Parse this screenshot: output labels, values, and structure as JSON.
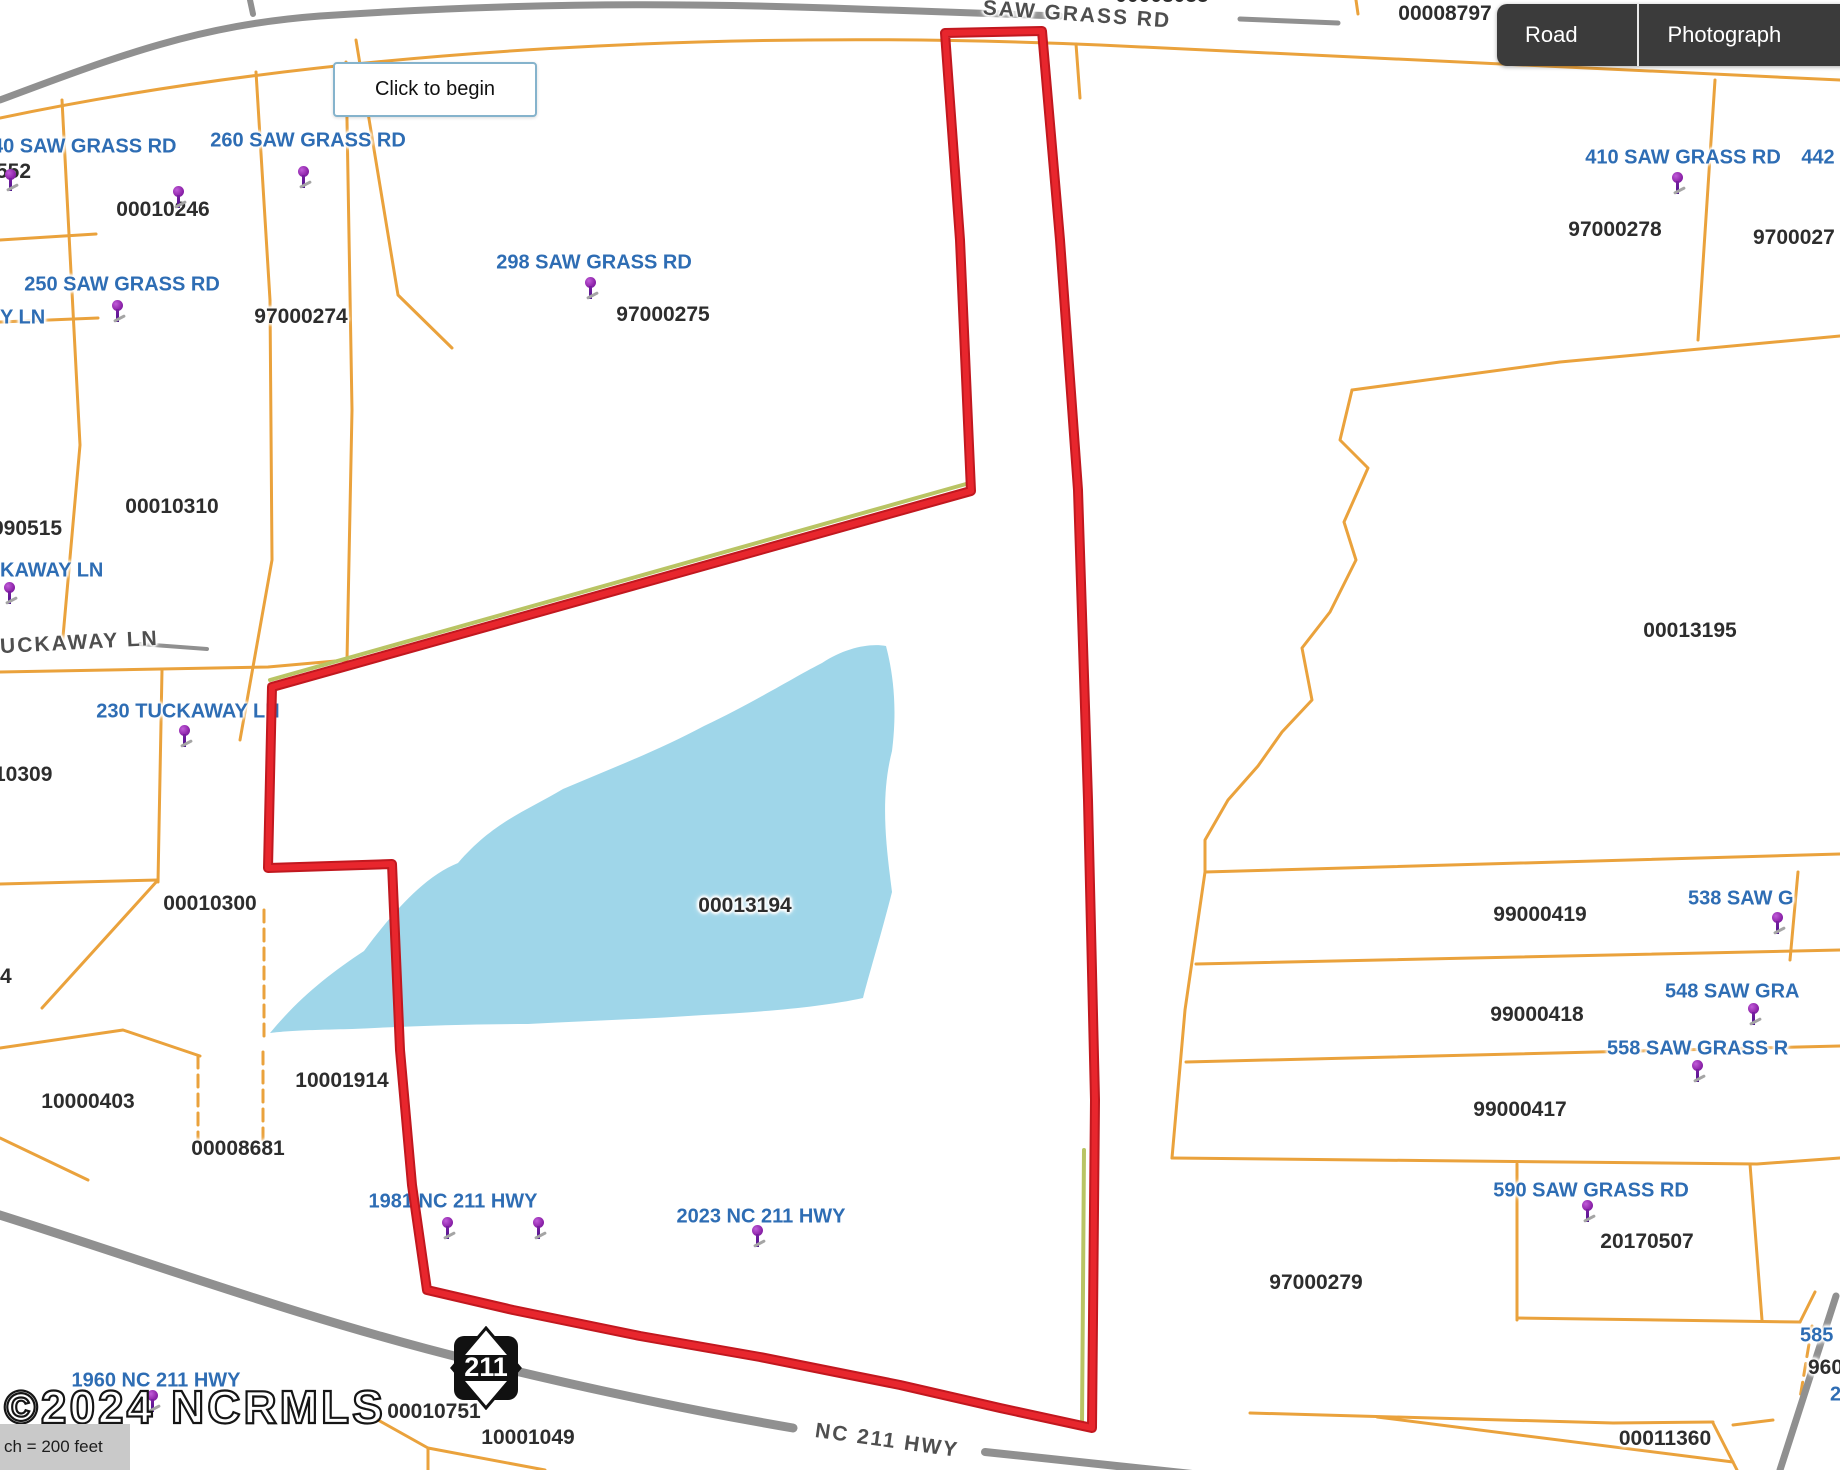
{
  "view_controls": {
    "buttons": [
      {
        "label": "Road Map"
      },
      {
        "label": "Photograph"
      }
    ]
  },
  "tooltip": {
    "text": "Click to begin"
  },
  "watermark": {
    "text": "©2024 NCRMLS"
  },
  "scale_bar": {
    "text": "ch = 200 feet"
  },
  "highway_shield": {
    "route": "211"
  },
  "colors": {
    "parcel_line": "#eaa23c",
    "road": "#909090",
    "water": "#9fd6e9",
    "subject_outline": "#dd2127",
    "address_text": "#2e6db4",
    "parcel_text": "#2d2d2d",
    "pin": "#8e24aa"
  },
  "map": {
    "road_labels": [
      {
        "text": "SAW GRASS RD",
        "x": 1077,
        "y": 15,
        "rot": 4
      },
      {
        "text": "UCKAWAY LN",
        "x": 0,
        "y": 643,
        "rot": -3,
        "anchor": "left"
      },
      {
        "text": "NC 211 HWY",
        "x": 887,
        "y": 1441,
        "rot": 8
      }
    ],
    "parcel_numbers": [
      {
        "text": "00008797",
        "x": 1445,
        "y": 14
      },
      {
        "text": "00008055",
        "x": 1162,
        "y": -4
      },
      {
        "text": "00010246",
        "x": 163,
        "y": 210
      },
      {
        "text": "552",
        "x": -4,
        "y": 172,
        "anchor": "left"
      },
      {
        "text": "97000274",
        "x": 301,
        "y": 317
      },
      {
        "text": "97000275",
        "x": 663,
        "y": 315
      },
      {
        "text": "97000278",
        "x": 1615,
        "y": 230
      },
      {
        "text": "9700027",
        "x": 1753,
        "y": 238,
        "anchor": "left"
      },
      {
        "text": "990515",
        "x": -8,
        "y": 529,
        "anchor": "left"
      },
      {
        "text": "00010310",
        "x": 172,
        "y": 507
      },
      {
        "text": "10309",
        "x": -6,
        "y": 775,
        "anchor": "left"
      },
      {
        "text": "00010300",
        "x": 210,
        "y": 904
      },
      {
        "text": "4",
        "x": 0,
        "y": 977,
        "anchor": "left"
      },
      {
        "text": "10000403",
        "x": 88,
        "y": 1102
      },
      {
        "text": "10001914",
        "x": 342,
        "y": 1081
      },
      {
        "text": "00008681",
        "x": 238,
        "y": 1149
      },
      {
        "text": "00013194",
        "x": 745,
        "y": 906
      },
      {
        "text": "00013195",
        "x": 1690,
        "y": 631
      },
      {
        "text": "99000419",
        "x": 1540,
        "y": 915
      },
      {
        "text": "99000418",
        "x": 1537,
        "y": 1015
      },
      {
        "text": "99000417",
        "x": 1520,
        "y": 1110
      },
      {
        "text": "97000279",
        "x": 1316,
        "y": 1283
      },
      {
        "text": "20170507",
        "x": 1647,
        "y": 1242
      },
      {
        "text": "960",
        "x": 1808,
        "y": 1368,
        "anchor": "left"
      },
      {
        "text": "00011360",
        "x": 1665,
        "y": 1439
      },
      {
        "text": "00010751",
        "x": 434,
        "y": 1412
      },
      {
        "text": "10001049",
        "x": 528,
        "y": 1438
      }
    ],
    "address_labels": [
      {
        "text": "40 SAW GRASS RD",
        "x": -8,
        "y": 147,
        "anchor": "left"
      },
      {
        "text": "260 SAW GRASS RD",
        "x": 308,
        "y": 141
      },
      {
        "text": "250 SAW GRASS RD",
        "x": 122,
        "y": 285
      },
      {
        "text": "Y LN",
        "x": 0,
        "y": 318,
        "anchor": "left"
      },
      {
        "text": "298 SAW GRASS RD",
        "x": 594,
        "y": 263
      },
      {
        "text": "KAWAY LN",
        "x": 0,
        "y": 571,
        "anchor": "left"
      },
      {
        "text": "230 TUCKAWAY LN",
        "x": 188,
        "y": 712
      },
      {
        "text": "410 SAW GRASS RD",
        "x": 1683,
        "y": 158
      },
      {
        "text": "442",
        "x": 1818,
        "y": 158
      },
      {
        "text": "538 SAW G",
        "x": 1688,
        "y": 899,
        "anchor": "left"
      },
      {
        "text": "548 SAW GRA",
        "x": 1665,
        "y": 992,
        "anchor": "left"
      },
      {
        "text": "558 SAW GRASS R",
        "x": 1607,
        "y": 1049,
        "anchor": "left"
      },
      {
        "text": "590 SAW GRASS RD",
        "x": 1591,
        "y": 1191
      },
      {
        "text": "585",
        "x": 1800,
        "y": 1336,
        "anchor": "left"
      },
      {
        "text": "2",
        "x": 1830,
        "y": 1395,
        "anchor": "left"
      },
      {
        "text": "1981 NC 211 HWY",
        "x": 453,
        "y": 1202
      },
      {
        "text": "2023 NC 211 HWY",
        "x": 761,
        "y": 1217
      },
      {
        "text": "1960 NC 211 HWY",
        "x": 156,
        "y": 1381
      }
    ],
    "pins": [
      {
        "x": 10,
        "y": 175
      },
      {
        "x": 178,
        "y": 192
      },
      {
        "x": 303,
        "y": 172
      },
      {
        "x": 117,
        "y": 306
      },
      {
        "x": 590,
        "y": 283
      },
      {
        "x": 9,
        "y": 588
      },
      {
        "x": 184,
        "y": 731
      },
      {
        "x": 1677,
        "y": 178
      },
      {
        "x": 1777,
        "y": 918
      },
      {
        "x": 1753,
        "y": 1009
      },
      {
        "x": 1697,
        "y": 1066
      },
      {
        "x": 1587,
        "y": 1206
      },
      {
        "x": 447,
        "y": 1223
      },
      {
        "x": 538,
        "y": 1223
      },
      {
        "x": 757,
        "y": 1231
      },
      {
        "x": 152,
        "y": 1396
      }
    ]
  }
}
